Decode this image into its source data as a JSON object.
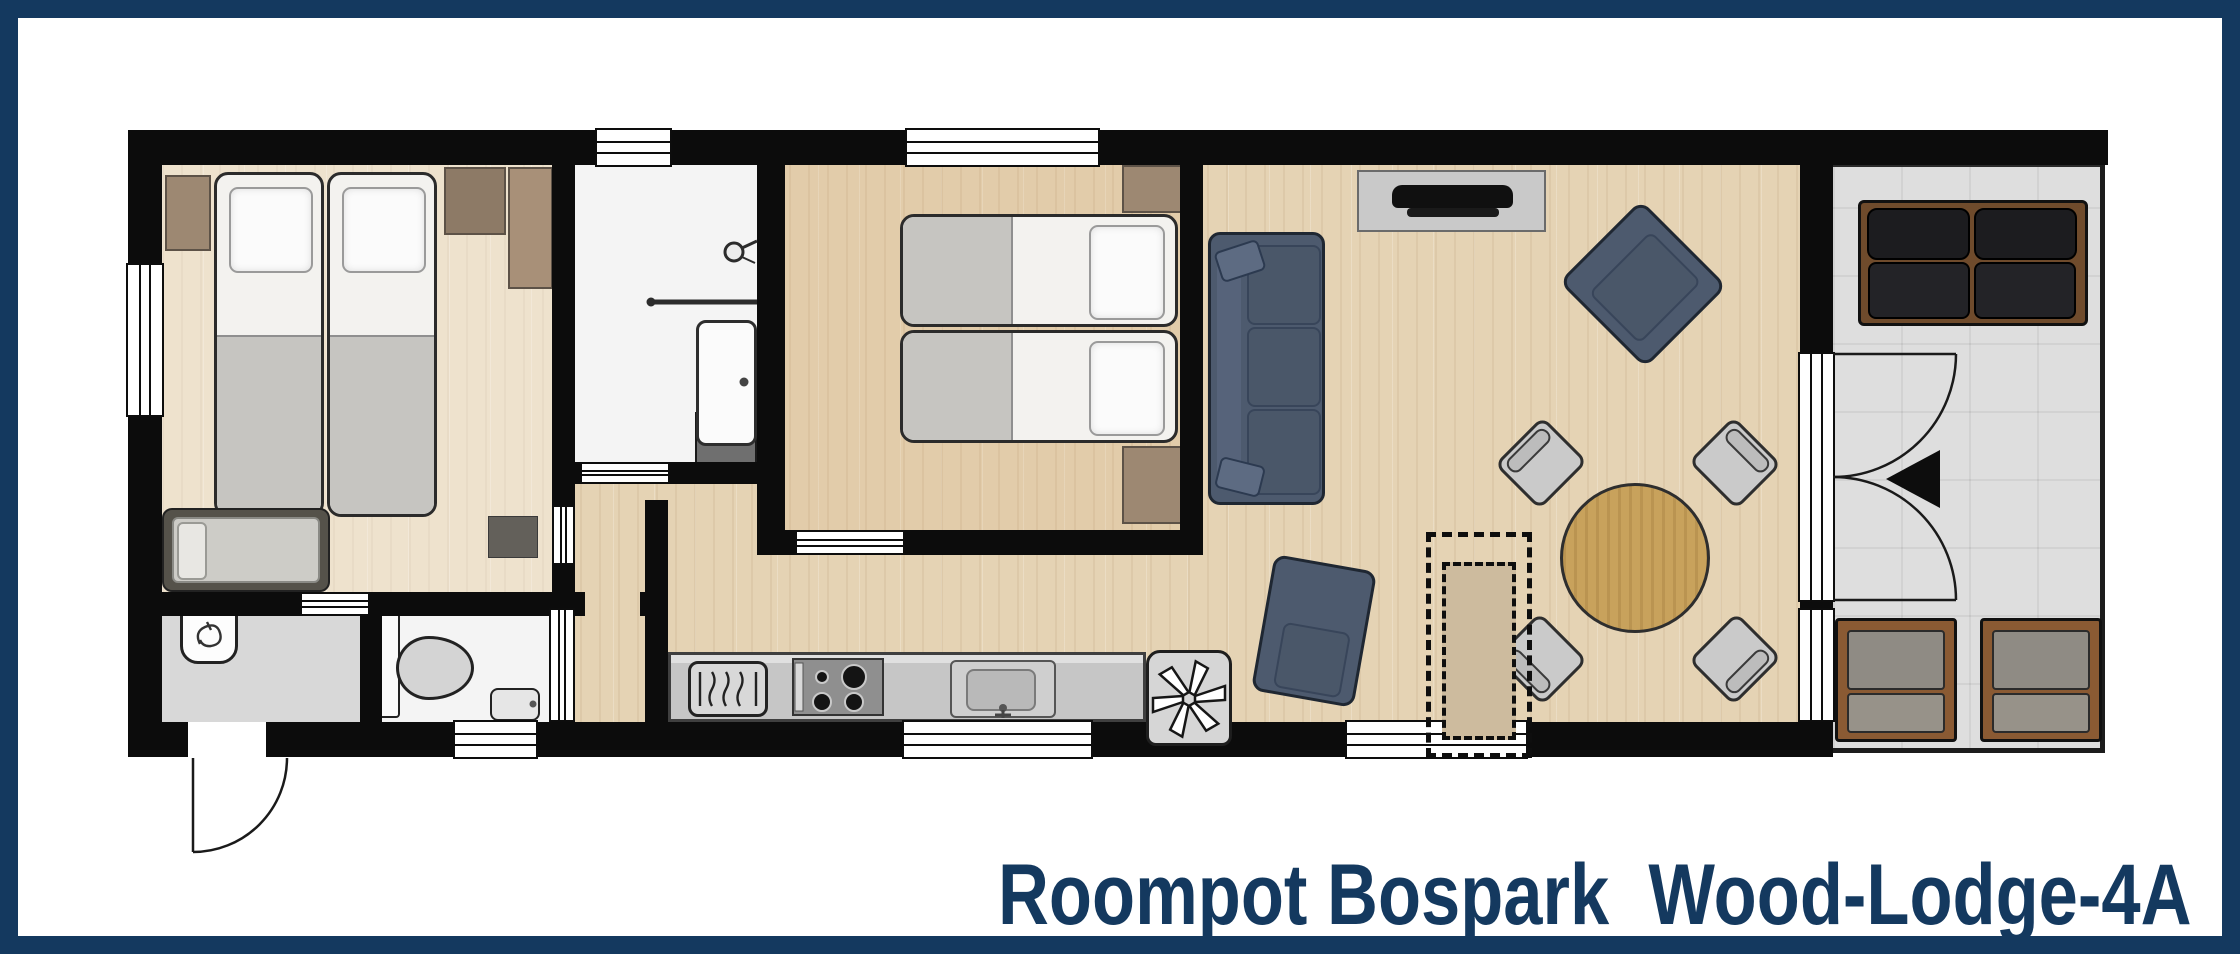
{
  "title": {
    "text": "Roompot Bospark  Wood-Lodge-4A"
  },
  "palette": {
    "frame_navy": "#14395f",
    "wall_black": "#0c0c0c",
    "wood_floor": "#e5d3b4",
    "hall_floor": "#d8d8d8",
    "wet_room_floor": "#f4f4f4",
    "terrace_tile": "#dedede",
    "sofa_slate": "#4d5a6e",
    "cabinet_brown": "#9d8872",
    "table_wood": "#c8a25c",
    "outdoor_sofa_black": "#1c1c1f",
    "outdoor_frame_brown": "#8a5a33"
  },
  "floorplan": {
    "rooms": [
      {
        "id": "bedroom-1",
        "floor": "wood"
      },
      {
        "id": "bathroom",
        "floor": "white"
      },
      {
        "id": "bedroom-2",
        "floor": "wood"
      },
      {
        "id": "living-kitchen",
        "floor": "wood"
      },
      {
        "id": "entrance-hall",
        "floor": "grey"
      },
      {
        "id": "toilet",
        "floor": "white"
      },
      {
        "id": "terrace",
        "floor": "tiles"
      }
    ],
    "furniture": [
      {
        "name": "twin-bed",
        "room": "bedroom-1",
        "count": 2
      },
      {
        "name": "cot-bed",
        "room": "bedroom-1",
        "count": 1
      },
      {
        "name": "nightstand",
        "room": "bedroom-1",
        "count": 1
      },
      {
        "name": "wardrobe",
        "room": "bedroom-1",
        "count": 2
      },
      {
        "name": "washing-machine",
        "room": "entrance-hall",
        "count": 1
      },
      {
        "name": "wc",
        "room": "toilet",
        "count": 1
      },
      {
        "name": "hand-basin",
        "room": "toilet",
        "count": 1
      },
      {
        "name": "shower",
        "room": "bathroom",
        "count": 1
      },
      {
        "name": "washbasin",
        "room": "bathroom",
        "count": 1
      },
      {
        "name": "twin-bed",
        "room": "bedroom-2",
        "count": 2
      },
      {
        "name": "nightstand",
        "room": "bedroom-2",
        "count": 2
      },
      {
        "name": "sofa",
        "room": "living-kitchen",
        "count": 1
      },
      {
        "name": "tv-sideboard",
        "room": "living-kitchen",
        "count": 1
      },
      {
        "name": "armchair",
        "room": "living-kitchen",
        "count": 2
      },
      {
        "name": "round-dining-table",
        "room": "living-kitchen",
        "count": 1
      },
      {
        "name": "dining-chair",
        "room": "living-kitchen",
        "count": 4
      },
      {
        "name": "kitchen-counter-dishwasher-hob-sink",
        "room": "living-kitchen",
        "count": 1
      },
      {
        "name": "wood-stove",
        "room": "living-kitchen",
        "count": 1
      },
      {
        "name": "optional-cupboard-dashed",
        "room": "living-kitchen",
        "count": 1
      },
      {
        "name": "outdoor-sofa",
        "room": "terrace",
        "count": 1
      },
      {
        "name": "outdoor-chair",
        "room": "terrace",
        "count": 2
      }
    ],
    "openings": {
      "windows": 7,
      "exterior_doors": [
        "entrance-door-bottom-left",
        "french-double-doors-to-terrace"
      ],
      "interior_doors": [
        "bedroom-1",
        "toilet",
        "hall-bedroom-1",
        "bathroom-sliding",
        "bedroom-2"
      ],
      "entrance_arrow": "left-pointing-triangle-at-french-doors"
    }
  }
}
